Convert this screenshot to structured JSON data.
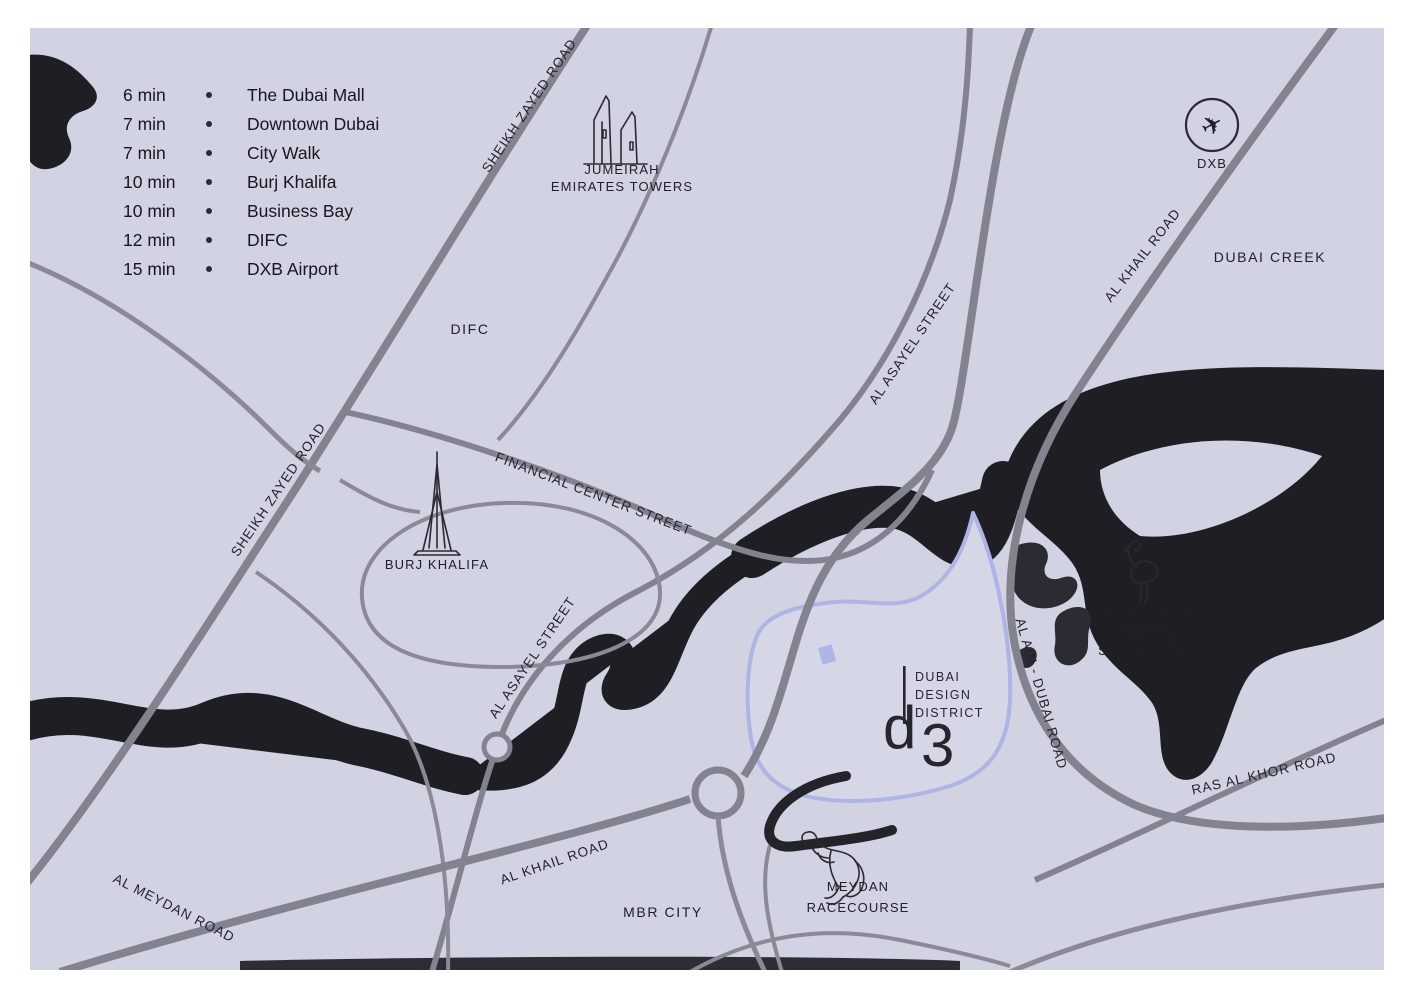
{
  "map_title": "Dubai Design District location map",
  "colors": {
    "map_background": "#d1d2e2",
    "water": "#1e1e24",
    "road": "#83838f",
    "district_outline": "#aeb4e3",
    "text": "#20202a",
    "frame": "#ffffff"
  },
  "legend": {
    "items": [
      {
        "time": "6 min",
        "place": "The Dubai Mall"
      },
      {
        "time": "7 min",
        "place": "Downtown Dubai"
      },
      {
        "time": "7 min",
        "place": "City Walk"
      },
      {
        "time": "10 min",
        "place": "Burj Khalifa"
      },
      {
        "time": "10 min",
        "place": "Business Bay"
      },
      {
        "time": "12 min",
        "place": "DIFC"
      },
      {
        "time": "15 min",
        "place": "DXB Airport"
      }
    ]
  },
  "roads": {
    "sheikh_zayed_top": "SHEIKH ZAYED ROAD",
    "sheikh_zayed_left": "SHEIKH ZAYED ROAD",
    "al_khail_top": "AL KHAIL ROAD",
    "al_khail_bottom": "AL KHAIL ROAD",
    "al_asayel_left": "AL ASAYEL STREET",
    "al_asayel_right": "AL ASAYEL STREET",
    "financial_center": "FINANCIAL CENTER STREET",
    "al_ain_dubai": "AL AIN - DUBAI ROAD",
    "ras_al_khor": "RAS AL KHOR ROAD",
    "al_meydan": "AL MEYDAN ROAD"
  },
  "areas": {
    "dubai_creek": "DUBAI CREEK",
    "difc": "DIFC",
    "mbr_city": "MBR CITY"
  },
  "landmarks": {
    "jumeirah": {
      "line1": "JUMEIRAH",
      "line2": "EMIRATES TOWERS"
    },
    "burj_khalifa": {
      "label": "BURJ KHALIFA"
    },
    "dxb": {
      "label": "DXB"
    },
    "ras_al_khor_sanctuary": {
      "line1": "RAS AL KHOR",
      "line2": "WILDLIFE",
      "line3": "SANCTUARY"
    },
    "meydan": {
      "line1": "MEYDAN",
      "line2": "RACECOURSE"
    },
    "d3": {
      "line1": "DUBAI",
      "line2": "DESIGN",
      "line3": "DISTRICT",
      "logo_d": "d",
      "logo_3": "3"
    }
  },
  "icons": {
    "plane_glyph": "✈"
  }
}
